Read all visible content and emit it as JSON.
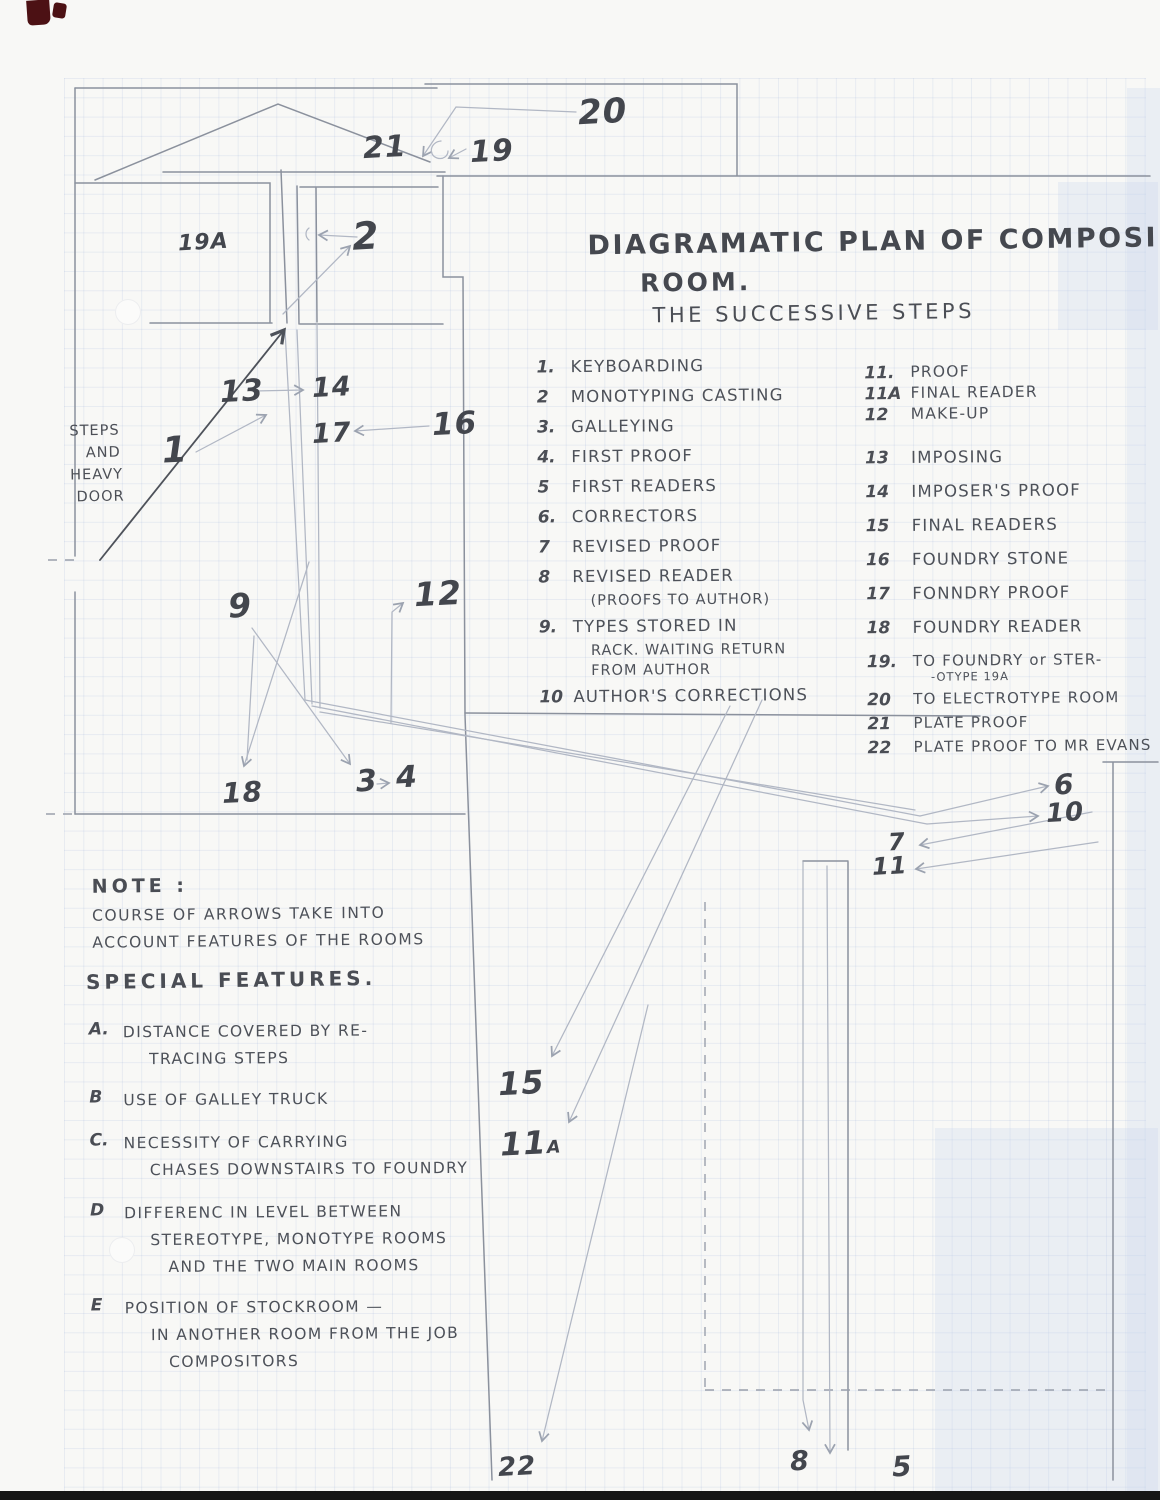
{
  "title": {
    "line1": "DIAGRAMATIC PLAN OF COMPOSING",
    "line2": "ROOM.",
    "line3": "THE SUCCESSIVE STEPS"
  },
  "steps_left": [
    {
      "num": "1.",
      "text": "KEYBOARDING"
    },
    {
      "num": "2",
      "text": "MONOTYPING CASTING"
    },
    {
      "num": "3.",
      "text": "GALLEYING"
    },
    {
      "num": "4.",
      "text": "FIRST PROOF"
    },
    {
      "num": "5",
      "text": "FIRST READERS"
    },
    {
      "num": "6.",
      "text": "CORRECTORS"
    },
    {
      "num": "7",
      "text": "REVISED PROOF"
    },
    {
      "num": "8",
      "text": "REVISED READER",
      "sub": [
        "(PROOFS TO AUTHOR)"
      ]
    },
    {
      "num": "9.",
      "text": "TYPES STORED IN",
      "sub": [
        "RACK. WAITING RETURN",
        "FROM AUTHOR"
      ]
    },
    {
      "num": "10",
      "text": "AUTHOR'S CORRECTIONS"
    }
  ],
  "steps_right": [
    {
      "num": "11.",
      "text": "PROOF"
    },
    {
      "num": "11A",
      "text": "FINAL READER"
    },
    {
      "num": "12",
      "text": "MAKE-UP"
    },
    {
      "num": "13",
      "text": "IMPOSING"
    },
    {
      "num": "14",
      "text": "IMPOSER'S PROOF"
    },
    {
      "num": "15",
      "text": "FINAL READERS"
    },
    {
      "num": "16",
      "text": "FOUNDRY STONE"
    },
    {
      "num": "17",
      "text": "FONNDRY PROOF"
    },
    {
      "num": "18",
      "text": "FOUNDRY READER"
    },
    {
      "num": "19.",
      "text": "TO FOUNDRY or STER-",
      "sub": [
        "-OTYPE 19A"
      ]
    },
    {
      "num": "20",
      "text": "TO ELECTROTYPE ROOM"
    },
    {
      "num": "21",
      "text": "PLATE PROOF"
    },
    {
      "num": "22",
      "text": "PLATE PROOF TO MR EVANS"
    }
  ],
  "note": {
    "heading": "NOTE :",
    "line1": "COURSE OF ARROWS TAKE INTO",
    "line2": "ACCOUNT FEATURES OF THE ROOMS"
  },
  "special": {
    "heading": "SPECIAL FEATURES.",
    "items": [
      {
        "num": "A.",
        "lines": [
          "DISTANCE COVERED BY RE-",
          "TRACING STEPS"
        ]
      },
      {
        "num": "B",
        "lines": [
          "USE OF GALLEY TRUCK"
        ]
      },
      {
        "num": "C.",
        "lines": [
          "NECESSITY OF CARRYING",
          "CHASES DOWNSTAIRS TO FOUNDRY"
        ]
      },
      {
        "num": "D",
        "lines": [
          "DIFFERENC IN LEVEL BETWEEN",
          "STEREOTYPE, MONOTYPE ROOMS",
          "AND THE TWO MAIN ROOMS"
        ]
      },
      {
        "num": "E",
        "lines": [
          "POSITION OF STOCKROOM —",
          "IN ANOTHER ROOM FROM THE JOB",
          "COMPOSITORS"
        ]
      }
    ]
  },
  "margin_note": {
    "lines": [
      "STEPS",
      "AND",
      "HEAVY",
      "DOOR"
    ]
  },
  "plan_labels": [
    {
      "text": "20",
      "x": 578,
      "y": 92,
      "size": 34
    },
    {
      "text": "21",
      "x": 363,
      "y": 130,
      "size": 30
    },
    {
      "text": "19",
      "x": 470,
      "y": 134,
      "size": 30
    },
    {
      "text": "2",
      "x": 352,
      "y": 214,
      "size": 38
    },
    {
      "text": "19A",
      "x": 178,
      "y": 230,
      "size": 22
    },
    {
      "text": "13",
      "x": 220,
      "y": 374,
      "size": 30
    },
    {
      "text": "14",
      "x": 312,
      "y": 372,
      "size": 27
    },
    {
      "text": "17",
      "x": 312,
      "y": 418,
      "size": 27
    },
    {
      "text": "16",
      "x": 432,
      "y": 406,
      "size": 31
    },
    {
      "text": "1",
      "x": 162,
      "y": 430,
      "size": 36
    },
    {
      "text": "9",
      "x": 228,
      "y": 586,
      "size": 33
    },
    {
      "text": "12",
      "x": 414,
      "y": 574,
      "size": 33
    },
    {
      "text": "18",
      "x": 222,
      "y": 776,
      "size": 28
    },
    {
      "text": "3",
      "x": 356,
      "y": 764,
      "size": 30
    },
    {
      "text": "4",
      "x": 396,
      "y": 760,
      "size": 30
    },
    {
      "text": "6",
      "x": 1054,
      "y": 768,
      "size": 28
    },
    {
      "text": "10",
      "x": 1046,
      "y": 798,
      "size": 26
    },
    {
      "text": "7",
      "x": 888,
      "y": 828,
      "size": 24
    },
    {
      "text": "11",
      "x": 872,
      "y": 852,
      "size": 24
    },
    {
      "text": "15",
      "x": 498,
      "y": 1064,
      "size": 32
    },
    {
      "text": "11",
      "sub": "A",
      "x": 500,
      "y": 1124,
      "size": 32
    },
    {
      "text": "22",
      "x": 498,
      "y": 1452,
      "size": 26
    },
    {
      "text": "8",
      "x": 790,
      "y": 1446,
      "size": 27
    },
    {
      "text": "5",
      "x": 892,
      "y": 1450,
      "size": 28
    }
  ],
  "colors": {
    "pencil": "#8b919d",
    "pencil_light": "#b1b7c4",
    "ink": "#4d5159",
    "corner_mark_red": "#4c1114",
    "paper": "#f8f8f6",
    "grid_blue": "#7894cd"
  }
}
